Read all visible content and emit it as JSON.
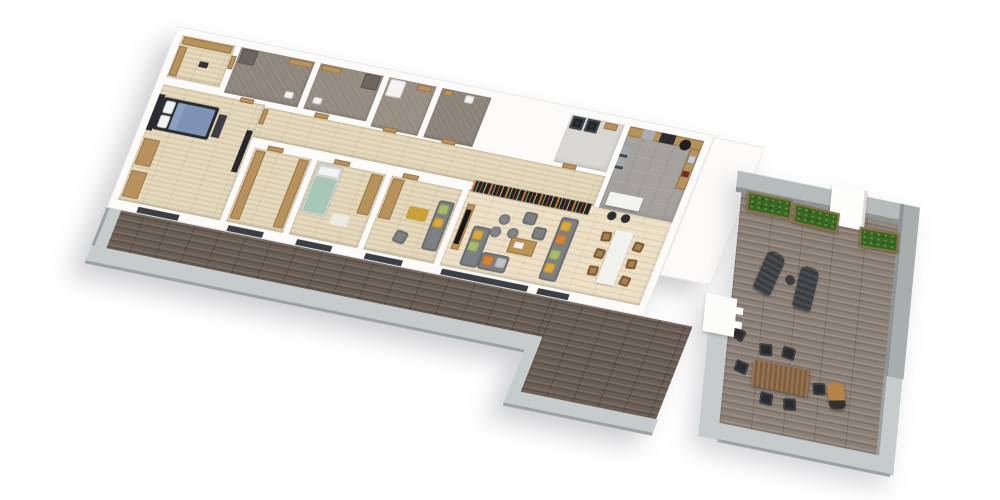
{
  "scene": {
    "description": "3D axonometric render of an apartment floor plan with long balcony and large roof terrace, viewed from above on a white background",
    "projection": "rotated top-down, approx 11.5deg tilt",
    "background": "#ffffff"
  },
  "palette": {
    "walls": "#fcfbfa",
    "wood_floor": "#e4d7ba",
    "living_floor": "#ecdfc5",
    "bathroom_floor": "#8e857b",
    "kitchen_tile": "#a5a29d",
    "balcony_deck": "#6b5e55",
    "terrace_deck": "#8d8177",
    "concrete_edge": "#c6cccb",
    "sofa_gray": "#7d8082",
    "wood_furniture": "#b8925c",
    "accent_yellow": "#d8a93e",
    "accent_green": "#a8bd69",
    "accent_orange": "#d78436",
    "bed_blue": "#7e93b5",
    "bed_teal": "#a9c7b8",
    "plant_green": "#3a6526",
    "window_dark": "#3a3f44",
    "bookshelf_dark": "#1f2126"
  },
  "apartment": {
    "rooms": [
      {
        "id": "walk-in-closet",
        "floor": "wood",
        "furniture": [
          "wardrobe-run-north",
          "wardrobe-run-west"
        ]
      },
      {
        "id": "bathroom-1",
        "floor": "gray-stone",
        "furniture": [
          "shower",
          "vanity",
          "toilet"
        ]
      },
      {
        "id": "bathroom-2",
        "floor": "gray-stone",
        "furniture": [
          "shower",
          "vanity",
          "toilet"
        ]
      },
      {
        "id": "shower-room",
        "floor": "gray-stone",
        "furniture": [
          "shower-tray",
          "bench"
        ]
      },
      {
        "id": "wc",
        "floor": "gray-stone",
        "furniture": [
          "toilet",
          "sink"
        ]
      },
      {
        "id": "utility-room",
        "floor": "light-tile",
        "furniture": [
          "washer",
          "dryer",
          "shelf"
        ]
      },
      {
        "id": "kitchen",
        "floor": "gray-tile",
        "furniture": [
          "north-counter",
          "cooktop",
          "steel-appliance",
          "east-counter",
          "sink",
          "tall-black-cylinder",
          "island",
          "bar-stool",
          "bar-stool"
        ]
      },
      {
        "id": "corridor",
        "floor": "wood",
        "furniture": [
          "doors-to-bathrooms",
          "doors-to-bedrooms"
        ]
      },
      {
        "id": "master-bedroom",
        "floor": "wood",
        "furniture": [
          "double-bed-blue",
          "headboard",
          "foot-bench",
          "dresser",
          "dresser",
          "tv-panel"
        ]
      },
      {
        "id": "wardrobe-room",
        "floor": "wood",
        "furniture": [
          "wardrobe-west",
          "wardrobe-east"
        ]
      },
      {
        "id": "bedroom-2",
        "floor": "wood",
        "furniture": [
          "single-bed-teal",
          "wardrobe",
          "rug"
        ]
      },
      {
        "id": "bedroom-3",
        "floor": "wood",
        "furniture": [
          "wardrobe",
          "sofa",
          "yellow-ottoman",
          "chair"
        ]
      },
      {
        "id": "living-dining",
        "floor": "light-wood",
        "furniture": [
          "bookshelf-wall",
          "tv-console",
          "tv",
          "corner-sofa",
          "straight-sofa",
          "cushions-yellow-green-orange",
          "round-poufs-x3",
          "square-ottomans-x2",
          "coffee-table",
          "white-dining-table",
          "dining-chairs-x6"
        ]
      }
    ],
    "balcony": {
      "deck": "dark-wood-planks",
      "edge": "light-concrete",
      "windows": 6
    },
    "window_count": 6
  },
  "terrace": {
    "deck": "gray-wood-planks",
    "walls": [
      "parapet-top",
      "parapet-right",
      "white-column"
    ],
    "items": [
      "planter-x3",
      "sun-lounger-x2",
      "round-side-table",
      "wood-dining-table",
      "dark-chairs-x7",
      "barrel-grill",
      "white-entry-step",
      "lower-deck-extension"
    ]
  }
}
